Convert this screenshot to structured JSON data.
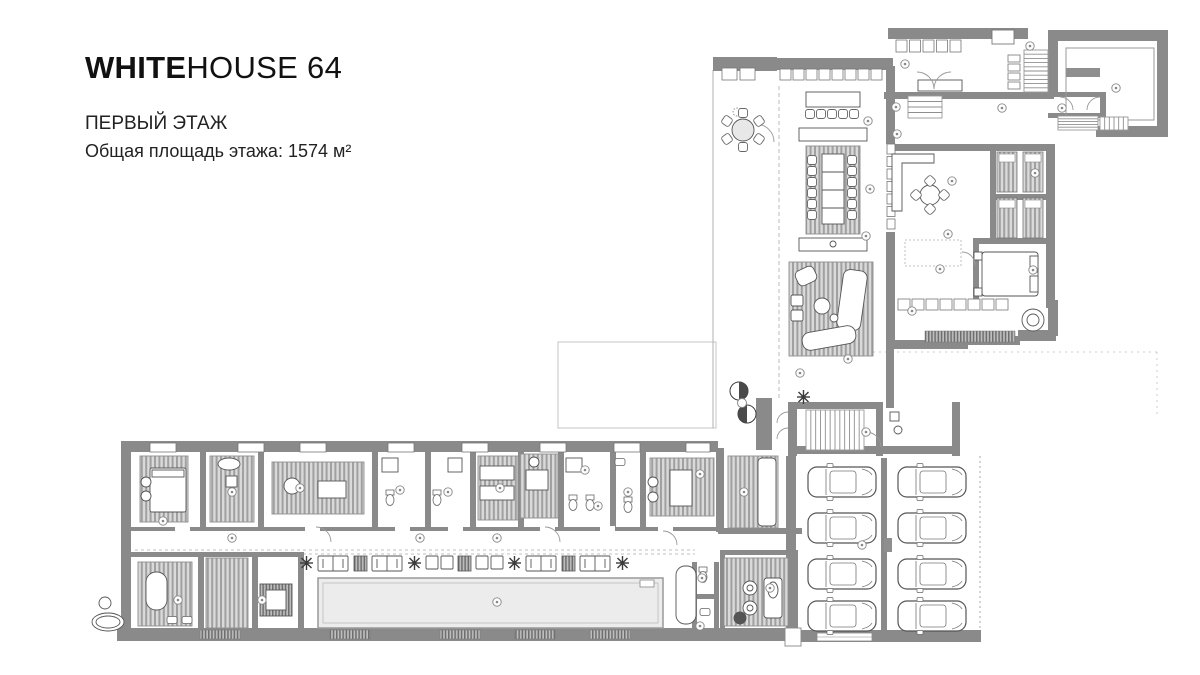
{
  "header": {
    "brand_bold": "WHITE",
    "brand_light": "HOUSE 64",
    "floor_label": "ПЕРВЫЙ ЭТАЖ",
    "area_label": "Общая площадь этажа: 1574 м²"
  },
  "plan": {
    "colors": {
      "wall": "#8a8a8a",
      "furniture_line": "#555555",
      "pool_fill": "#ececec",
      "hatch_dark": "#6e6e6e",
      "hatch_light": "#a0a0a0"
    },
    "stripe_rooms": [
      [
        806,
        146,
        54,
        88
      ],
      [
        789,
        262,
        84,
        94
      ],
      [
        140,
        456,
        48,
        66
      ],
      [
        210,
        456,
        44,
        66
      ],
      [
        272,
        462,
        92,
        52
      ],
      [
        478,
        456,
        40,
        64
      ],
      [
        520,
        454,
        38,
        64
      ],
      [
        650,
        458,
        64,
        58
      ],
      [
        728,
        456,
        50,
        72
      ],
      [
        138,
        562,
        54,
        64
      ],
      [
        206,
        558,
        42,
        70
      ],
      [
        724,
        558,
        64,
        68
      ]
    ],
    "beds_small": [
      [
        997,
        152
      ],
      [
        1023,
        152
      ],
      [
        997,
        198
      ],
      [
        1023,
        198
      ]
    ],
    "gray_blocks": [
      [
        828,
        93,
        20,
        10
      ],
      [
        805,
        130,
        13,
        9
      ],
      [
        821,
        130,
        13,
        9
      ],
      [
        837,
        130,
        13,
        9
      ],
      [
        853,
        130,
        13,
        9
      ],
      [
        800,
        239,
        10,
        11
      ],
      [
        857,
        239,
        10,
        11
      ],
      [
        1066,
        68,
        34,
        9
      ],
      [
        884,
        538,
        8,
        14
      ]
    ],
    "window_boxes": [
      [
        150,
        443,
        26,
        9
      ],
      [
        238,
        443,
        26,
        9
      ],
      [
        300,
        443,
        26,
        9
      ],
      [
        388,
        443,
        26,
        9
      ],
      [
        462,
        443,
        26,
        9
      ],
      [
        540,
        443,
        26,
        9
      ],
      [
        614,
        443,
        26,
        9
      ],
      [
        686,
        443,
        24,
        9
      ]
    ],
    "window_rows": [
      {
        "x": 780,
        "y": 69,
        "n": 8,
        "dx": 13,
        "dy": 0,
        "w": 11,
        "h": 11
      },
      {
        "x": 722,
        "y": 68,
        "n": 2,
        "dx": 18,
        "dy": 0,
        "w": 15,
        "h": 12
      },
      {
        "x": 887,
        "y": 144,
        "n": 7,
        "dx": 0,
        "dy": 12.5,
        "w": 8,
        "h": 10
      },
      {
        "x": 898,
        "y": 299,
        "n": 8,
        "dx": 14,
        "dy": 0,
        "w": 12,
        "h": 11
      },
      {
        "x": 1008,
        "y": 55,
        "n": 4,
        "dx": 0,
        "dy": 9,
        "w": 12,
        "h": 7
      },
      {
        "x": 896,
        "y": 40,
        "n": 5,
        "dx": 13.5,
        "dy": 0,
        "w": 11,
        "h": 12
      }
    ],
    "sills": [
      [
        200,
        630,
        40,
        9
      ],
      [
        330,
        630,
        40,
        9
      ],
      [
        440,
        630,
        40,
        9
      ],
      [
        515,
        630,
        40,
        9
      ],
      [
        590,
        630,
        40,
        9
      ],
      [
        925,
        331,
        90,
        11
      ]
    ],
    "door_gaps": [
      [
        175,
        526,
        15,
        6
      ],
      [
        305,
        526,
        15,
        6
      ],
      [
        395,
        526,
        15,
        6
      ],
      [
        448,
        526,
        15,
        6
      ],
      [
        540,
        526,
        15,
        6
      ],
      [
        600,
        526,
        15,
        6
      ],
      [
        658,
        526,
        15,
        6
      ]
    ],
    "cars": [
      [
        842,
        482
      ],
      [
        932,
        482
      ],
      [
        842,
        528
      ],
      [
        932,
        528
      ],
      [
        842,
        574
      ],
      [
        932,
        574
      ],
      [
        842,
        616
      ],
      [
        932,
        616
      ]
    ],
    "chairs": [
      [
        812,
        160,
        0
      ],
      [
        812,
        171,
        0
      ],
      [
        812,
        182,
        0
      ],
      [
        812,
        193,
        0
      ],
      [
        812,
        204,
        0
      ],
      [
        812,
        215,
        0
      ],
      [
        852,
        160,
        0
      ],
      [
        852,
        171,
        0
      ],
      [
        852,
        182,
        0
      ],
      [
        852,
        193,
        0
      ],
      [
        852,
        204,
        0
      ],
      [
        852,
        215,
        0
      ],
      [
        810,
        114,
        0
      ],
      [
        821,
        114,
        0
      ],
      [
        832,
        114,
        0
      ],
      [
        843,
        114,
        0
      ],
      [
        854,
        114,
        0
      ],
      [
        743,
        113,
        0
      ],
      [
        727,
        121,
        -55
      ],
      [
        727,
        139,
        55
      ],
      [
        743,
        147,
        0
      ],
      [
        759,
        139,
        -55
      ],
      [
        759,
        121,
        55
      ],
      [
        916,
        195,
        45
      ],
      [
        944,
        195,
        45
      ],
      [
        930,
        181,
        45
      ],
      [
        930,
        209,
        45
      ]
    ],
    "loungers": [
      [
        "snow",
        300
      ],
      [
        "pair",
        318
      ],
      [
        "tbl",
        354
      ],
      [
        "pair",
        372
      ],
      [
        "snow",
        408
      ],
      [
        "cube",
        426
      ],
      [
        "tbl",
        458
      ],
      [
        "cube",
        476
      ],
      [
        "snow",
        508
      ],
      [
        "pair",
        526
      ],
      [
        "tbl",
        562
      ],
      [
        "pair",
        580
      ],
      [
        "snow",
        616
      ]
    ],
    "stairs": [
      [
        806,
        410,
        58,
        40,
        11,
        "v"
      ],
      [
        1024,
        50,
        24,
        42,
        9,
        "h"
      ],
      [
        1058,
        116,
        40,
        14,
        4,
        "h"
      ],
      [
        1100,
        117,
        28,
        13,
        5,
        "v"
      ],
      [
        908,
        96,
        34,
        22,
        3,
        "h"
      ]
    ],
    "markers": [
      [
        905,
        64
      ],
      [
        1030,
        46
      ],
      [
        1116,
        88
      ],
      [
        896,
        107
      ],
      [
        1002,
        108
      ],
      [
        1062,
        108
      ],
      [
        868,
        121
      ],
      [
        897,
        134
      ],
      [
        870,
        189
      ],
      [
        952,
        181
      ],
      [
        1035,
        173
      ],
      [
        866,
        236
      ],
      [
        948,
        234
      ],
      [
        940,
        269
      ],
      [
        1033,
        270
      ],
      [
        912,
        311
      ],
      [
        848,
        359
      ],
      [
        800,
        373
      ],
      [
        866,
        432
      ],
      [
        862,
        545
      ],
      [
        163,
        521
      ],
      [
        232,
        492
      ],
      [
        300,
        488
      ],
      [
        400,
        490
      ],
      [
        448,
        492
      ],
      [
        500,
        488
      ],
      [
        585,
        470
      ],
      [
        598,
        506
      ],
      [
        628,
        492
      ],
      [
        700,
        474
      ],
      [
        744,
        492
      ],
      [
        232,
        538
      ],
      [
        420,
        538
      ],
      [
        497,
        538
      ],
      [
        178,
        600
      ],
      [
        262,
        600
      ],
      [
        497,
        602
      ],
      [
        702,
        578
      ],
      [
        700,
        626
      ],
      [
        770,
        588
      ]
    ]
  }
}
